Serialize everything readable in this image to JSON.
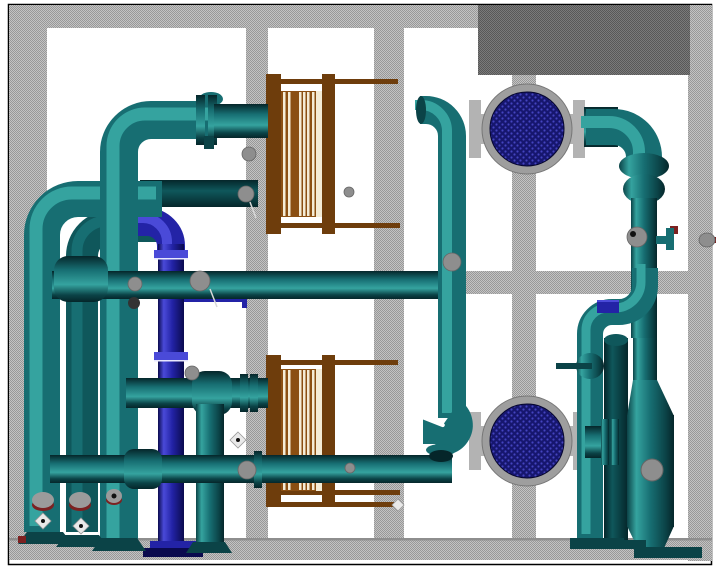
{
  "scene": {
    "description_label": "3D plant piping model viewport",
    "colors": {
      "canvas_white": "#ffffff",
      "border_line": "#000000",
      "dither_light_a": "#c3c3c3",
      "dither_light_b": "#989898",
      "dither_dark_a": "#7a7a7a",
      "dither_dark_b": "#585858",
      "teal_light": "#35a39f",
      "teal_mid": "#176e72",
      "teal_dark": "#0b4347",
      "teal_deep": "#05262a",
      "teal_back_mid": "#0f575b",
      "navy_light": "#4a4ad8",
      "navy_mid": "#2323a6",
      "navy_dark": "#0a0a4e",
      "hx_frame_brown": "#6e3d0c",
      "hx_pack_brown": "#8a4f12",
      "hx_plate_stripe": "#f4ecd6",
      "ring_gray": "#9e9e9e",
      "tube_navy": "#16166e",
      "tube_dot": "#4444c0",
      "flange_gray": "#b3b3b3",
      "valve_red": "#7c2121",
      "wheel_gray": "#9b9b9b",
      "metal_gray": "#8e8e8e",
      "flange_white": "#e8e8ff"
    },
    "equipment": [
      {
        "id": "plate-hx-top",
        "label": "plate-heat-exchanger-upper"
      },
      {
        "id": "plate-hx-bottom",
        "label": "plate-heat-exchanger-lower"
      },
      {
        "id": "shell-hx-top",
        "label": "shell-tube-exchanger-upper"
      },
      {
        "id": "shell-hx-bottom",
        "label": "shell-tube-exchanger-lower"
      },
      {
        "id": "separator-vessel",
        "label": "vertical-separator-vessel"
      },
      {
        "id": "navy-riser",
        "label": "blue-riser-pipe"
      },
      {
        "id": "teal-piping",
        "label": "cooling-water-piping"
      }
    ]
  }
}
